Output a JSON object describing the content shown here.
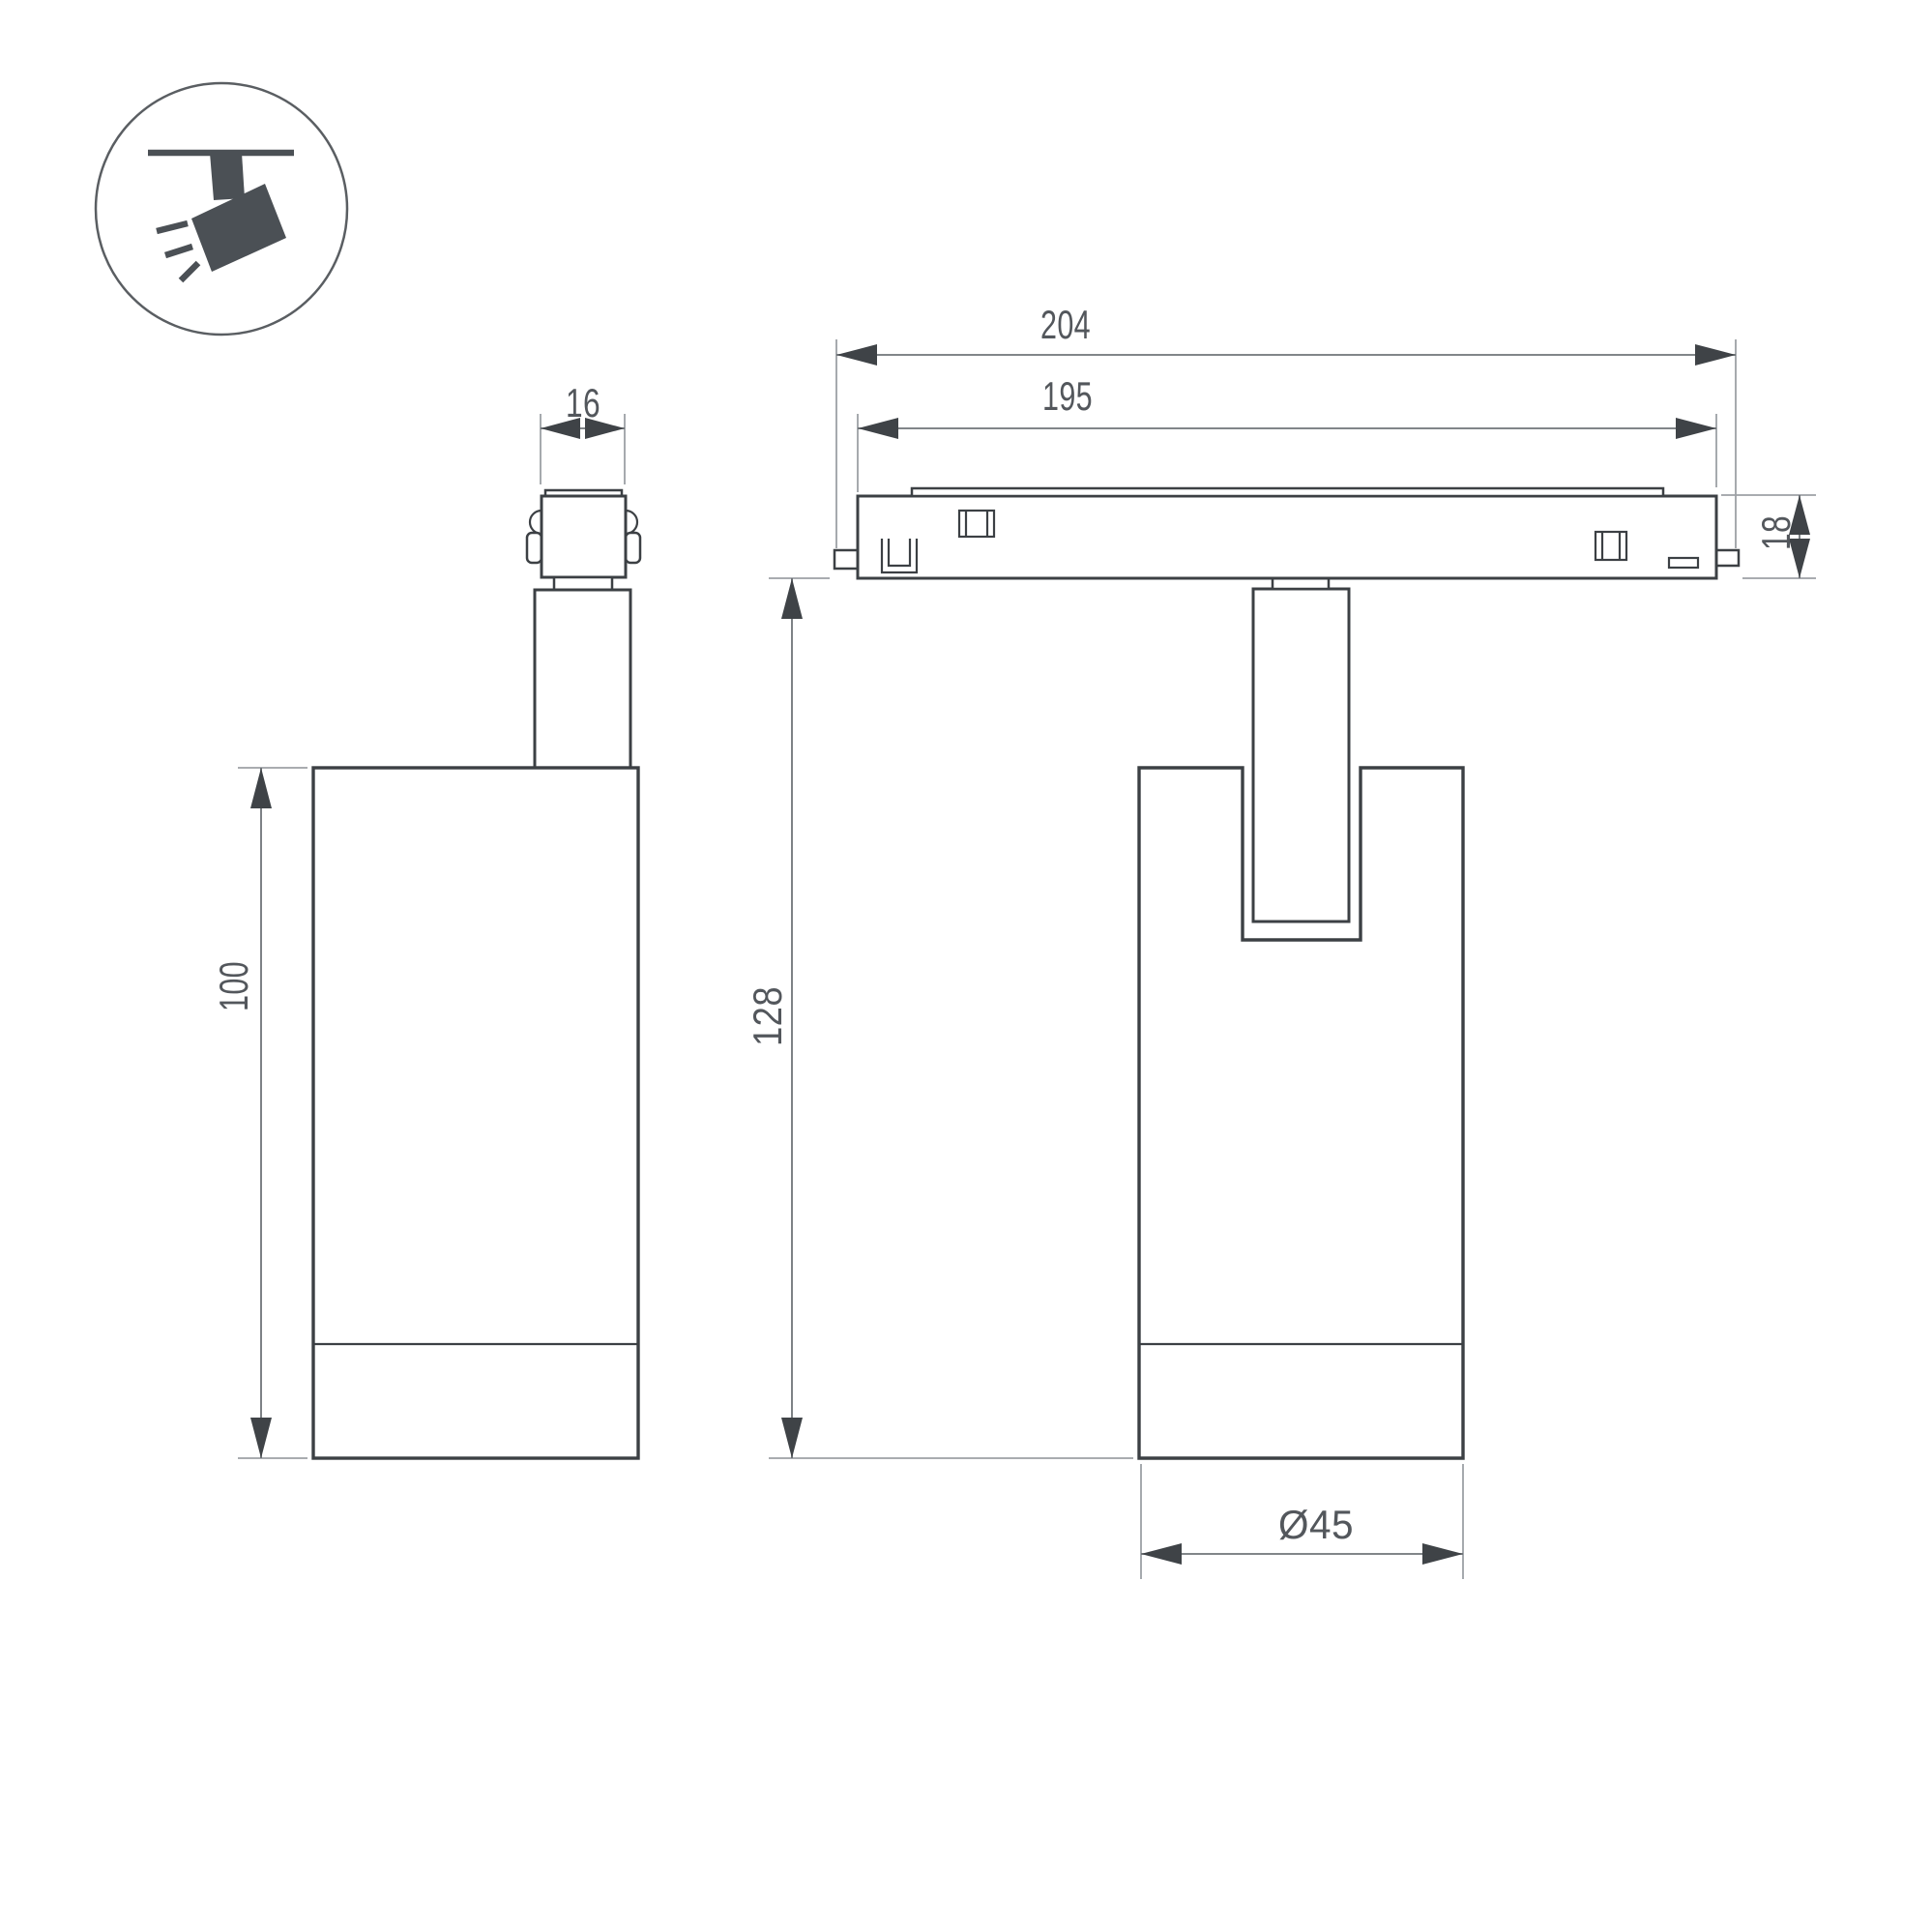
{
  "drawing": {
    "dimensions": {
      "connector_width": "16",
      "track_overall_length": "204",
      "track_visible_length": "195",
      "track_height": "18",
      "body_height": "100",
      "overall_drop_height": "128",
      "body_diameter": "Ø45"
    },
    "icon": {
      "name": "ceiling-track-spotlight"
    },
    "colors": {
      "background": "#ffffff",
      "outline": "#3c4044",
      "dimension_line": "#6f7478",
      "extension_line": "#9da1a5",
      "dimension_text": "#53575c",
      "icon_fill": "#4b5055"
    }
  }
}
